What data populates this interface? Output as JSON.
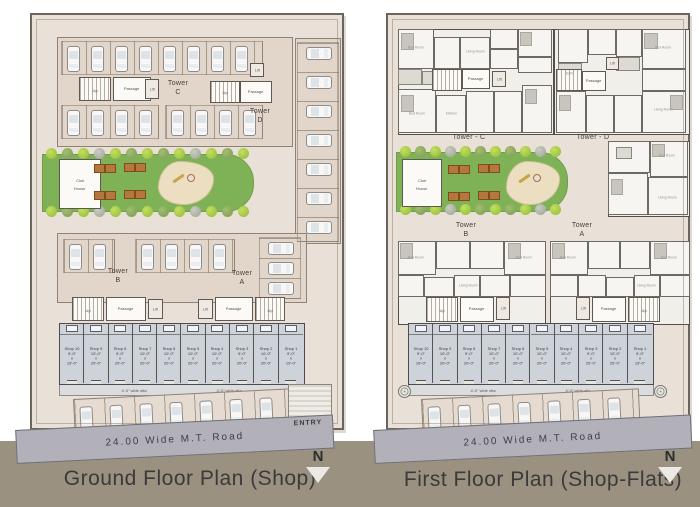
{
  "meta": {
    "legend_left": "Ground Floor Plan (Shop)",
    "legend_right": "First Floor Plan (Shop-Flats)"
  },
  "labels": {
    "road": "24.00 Wide  M.T. Road",
    "entry": "ENTRY",
    "north": "N",
    "passage": "Passage",
    "lift": "Lift",
    "up": "Up",
    "club_house_1": "Club",
    "club_house_2": "House",
    "otta": "4'-0\" wide otta",
    "x": "x"
  },
  "towers": {
    "left": {
      "c": [
        "Tower",
        "C"
      ],
      "d": [
        "Tower",
        "D"
      ],
      "b": [
        "Tower",
        "B"
      ],
      "a": [
        "Tower",
        "A"
      ]
    },
    "right_upper": {
      "c": "Tower - C",
      "d": "Tower - D"
    },
    "right_lower": {
      "b": [
        "Tower",
        "B"
      ],
      "a": [
        "Tower",
        "A"
      ]
    }
  },
  "rooms": {
    "bed": "Bed Room",
    "living": "Living Room",
    "kitchen": "Kitchen",
    "bath": "Bath"
  },
  "shops": {
    "stalls": [
      {
        "name": "Shop 10",
        "w": "9'-0\"",
        "d": "19'-0\""
      },
      {
        "name": "Shop 9",
        "w": "10'-0\"",
        "d": "20'-0\""
      },
      {
        "name": "Shop 8",
        "w": "9'-0\"",
        "d": "20'-0\""
      },
      {
        "name": "Shop 7",
        "w": "10'-0\"",
        "d": "20'-0\""
      },
      {
        "name": "Shop 6",
        "w": "10'-0\"",
        "d": "20'-0\""
      },
      {
        "name": "Shop 5",
        "w": "10'-0\"",
        "d": "20'-0\""
      },
      {
        "name": "Shop 4",
        "w": "10'-0\"",
        "d": "20'-0\""
      },
      {
        "name": "Shop 3",
        "w": "9'-0\"",
        "d": "20'-0\""
      },
      {
        "name": "Shop 2",
        "w": "10'-0\"",
        "d": "20'-0\""
      },
      {
        "name": "Shop 1",
        "w": "9'-0\"",
        "d": "19'-0\""
      }
    ]
  },
  "decor": {
    "left": {
      "top_row1": 8,
      "top_row2a": 4,
      "top_row2b": 4,
      "right_col": 7,
      "mid_a": 2,
      "mid_b": 4,
      "mid_col": 3,
      "bottom_row": 7,
      "trees": 13
    },
    "right": {
      "bottom_row": 7,
      "trees": 11
    }
  }
}
